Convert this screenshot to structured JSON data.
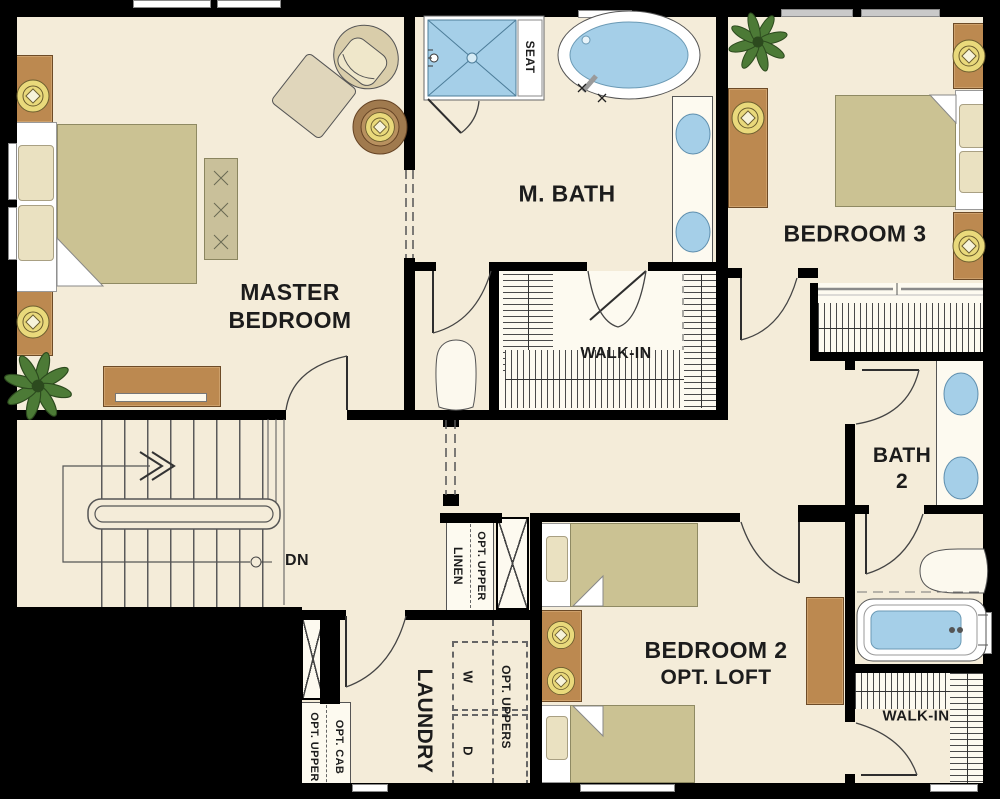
{
  "colors": {
    "background": "#000000",
    "floor": "#f4ecd9",
    "closet_floor": "#fdfaf0",
    "wall": "#000000",
    "wood_furniture": "#bc8950",
    "bed_linen": "#cbc293",
    "fixture_blue": "#a5cfe8",
    "lamp_yellow": "#e9d97b",
    "plant_green": "#4c7a36",
    "text": "#1c1c1c"
  },
  "rooms": {
    "master_bedroom": {
      "line1": "MASTER",
      "line2": "BEDROOM"
    },
    "master_bath": {
      "label": "M. BATH"
    },
    "bedroom3": {
      "label": "BEDROOM 3"
    },
    "master_walkin": {
      "label": "WALK-IN"
    },
    "bath2": {
      "line1": "BATH",
      "line2": "2"
    },
    "bedroom2": {
      "line1": "BEDROOM 2",
      "line2": "OPT. LOFT"
    },
    "laundry": {
      "label": "LAUNDRY"
    },
    "walkin2": {
      "label": "WALK-IN"
    }
  },
  "annotations": {
    "seat": "SEAT",
    "down": "DN",
    "linen": "LINEN",
    "linen_opt_upper": "OPT. UPPER",
    "opt_uppers": "OPT. UPPERS",
    "washer": "W",
    "dryer": "D",
    "opt_upper": "OPT. UPPER",
    "opt_cab": "OPT. CAB"
  }
}
